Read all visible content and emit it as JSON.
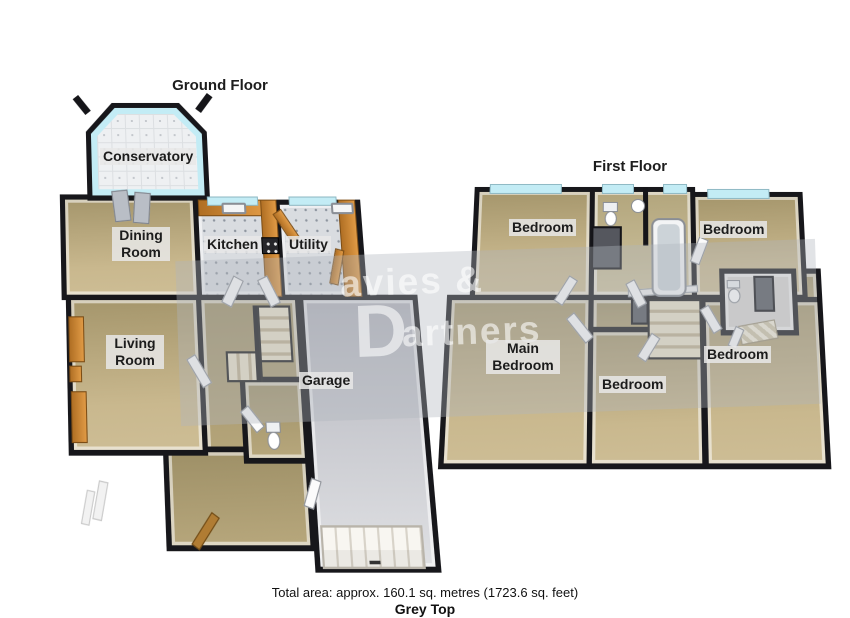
{
  "page": {
    "width": 850,
    "height": 618,
    "background": "#ffffff"
  },
  "ground_floor": {
    "title": "Ground Floor",
    "rooms": {
      "conservatory": "Conservatory",
      "dining": "Dining Room",
      "kitchen": "Kitchen",
      "utility": "Utility",
      "living": "Living Room",
      "garage": "Garage"
    }
  },
  "first_floor": {
    "title": "First Floor",
    "rooms": {
      "bedroom_top_left": "Bedroom",
      "bedroom_top_right": "Bedroom",
      "main_bedroom": "Main Bedroom",
      "bedroom_bottom_middle": "Bedroom",
      "bedroom_bottom_right": "Bedroom"
    }
  },
  "watermark": {
    "initial": "D",
    "line1": "avies &",
    "line2": "artners"
  },
  "footer": {
    "total_area": "Total area: approx. 160.1 sq. metres (1723.6 sq. feet)",
    "branding": "Grey Top"
  },
  "colors": {
    "wall": "#17171b",
    "floor_tan": "#c0ae82",
    "floor_tile_grey": "#d9dce0",
    "window_glass": "#c3ecf5",
    "counter_orange": "#cd8937",
    "garage_grey": "#c6c7cd"
  }
}
